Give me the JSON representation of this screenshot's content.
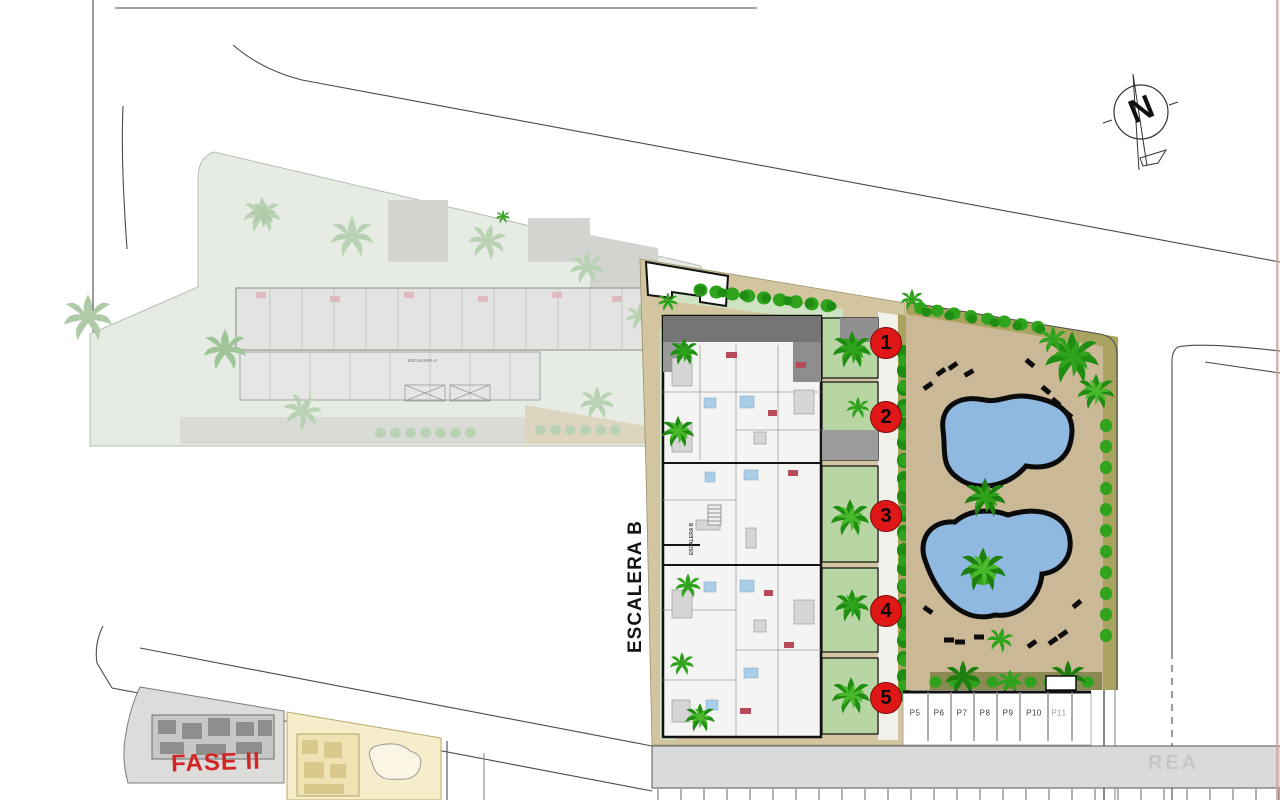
{
  "title": "Residential development site plan",
  "site": {
    "escalera_b_label": "ESCALERA B",
    "escalera_b_inner_label": "ESCALERA B",
    "escalera_a_inner_label": "ESCALERA A",
    "fase2_label": "FASE II",
    "watermark": "REA"
  },
  "compass": {
    "north_label": "N"
  },
  "units": [
    {
      "number": "1"
    },
    {
      "number": "2"
    },
    {
      "number": "3"
    },
    {
      "number": "4"
    },
    {
      "number": "5"
    }
  ],
  "parking": {
    "spaces": [
      {
        "label": "P5"
      },
      {
        "label": "P6"
      },
      {
        "label": "P7"
      },
      {
        "label": "P8"
      },
      {
        "label": "P9"
      },
      {
        "label": "P10"
      },
      {
        "label": "P11"
      }
    ]
  },
  "colors": {
    "unit_badge_red": "#e01717",
    "fase2_red": "#d32525",
    "pool_blue": "#8fb9e0",
    "deck_tan": "#d3c5a0",
    "pool_deck_tan": "#cab896",
    "olive_border": "#a8a35f",
    "garden_green": "#b8d5a4",
    "tree_green": "#2fa31c",
    "tree_green_dark": "#1f8c12",
    "faded_parcel_green": "#e6ece3",
    "faded_tree_green": "#b9d2b3",
    "road_gray": "#dadada",
    "roof_gray": "#757575"
  }
}
